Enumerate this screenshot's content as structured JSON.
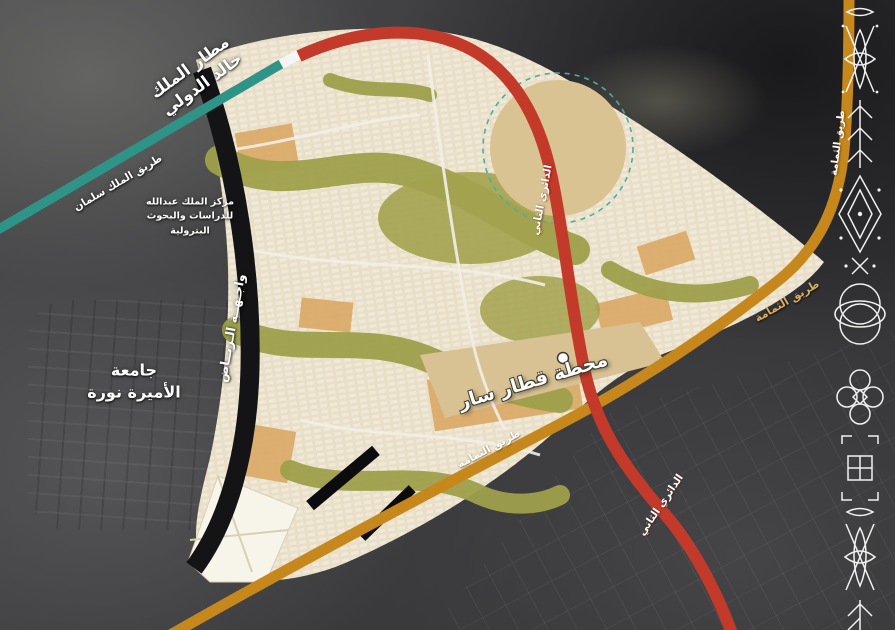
{
  "landmarks": {
    "airport": {
      "line1": "مطار الملك",
      "line2": "خالد الدولي"
    },
    "kapsarc": {
      "line1": "مركز الملك عبدالله",
      "line2": "للدراسات والبحوث",
      "line3": "البترولية"
    },
    "university": {
      "line1": "جامعة",
      "line2": "الأميرة نورة"
    },
    "train_station": {
      "label": "محطة قطار سار"
    },
    "riyadh_front": {
      "label": "واجـهــة الـريــاض"
    }
  },
  "roads": {
    "king_salman": {
      "label": "طريق الملك سلمان",
      "color": "#2e9487"
    },
    "second_ring": {
      "label": "الدائري الثاني",
      "color": "#c33a2b"
    },
    "thumamah": {
      "label": "طريق الثمامة",
      "color": "#c6881c"
    }
  },
  "map_features": {
    "master_plan_area_color": "#e9dfc8",
    "park_corridor_color": "#9fa04b",
    "open_sand_color": "#d9c393",
    "district_color": "#d9a55f",
    "satellite_base_color": "#3b3b3e",
    "sadu_pattern_color": "#ffffff",
    "reserve_outline_color": "#45b0a0"
  }
}
